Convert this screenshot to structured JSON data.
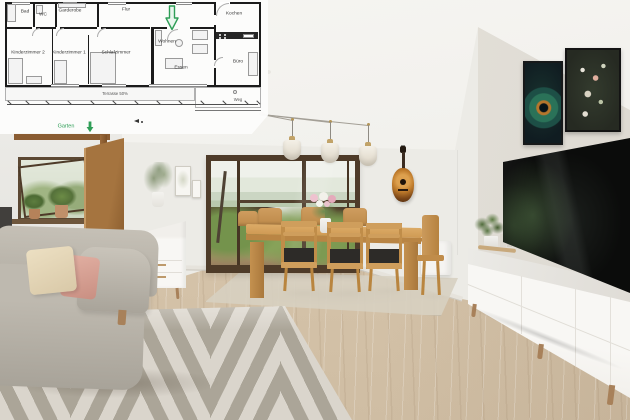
{
  "floorplan": {
    "rooms": [
      {
        "label": "Bad"
      },
      {
        "label": "WC"
      },
      {
        "label": "Garderobe"
      },
      {
        "label": "Flur"
      },
      {
        "label": "Kochen"
      },
      {
        "label": "Kinderzimmer 2"
      },
      {
        "label": "Kinderzimmer 1"
      },
      {
        "label": "Schlafzimmer"
      },
      {
        "label": "Wohnen"
      },
      {
        "label": "Essen"
      },
      {
        "label": "Büro"
      }
    ],
    "areas": {
      "terrace": "Terrasse 50%",
      "path": "Weg",
      "garden": "Garten"
    },
    "highlight_color": "#2f9e57",
    "wall_color": "#1b1b1b",
    "paper_color": "#fbfbfa"
  },
  "photo": {
    "colors": {
      "ceiling": "#f5f4f1",
      "wall": "#ecebe6",
      "floor_wood": "#d2c0a6",
      "window_frame": "#4e3b29",
      "foliage": "#7d9a52",
      "table_oak": "#cf9a54",
      "rug_light": "#dad5cc",
      "rug_dark": "#aba598",
      "sofa": "#b9b4aa",
      "cushion_cream": "#e7dcc0",
      "cushion_blush": "#d8a396",
      "sideboard": "#f6f5f2",
      "tv_screen": "#0b0c0b",
      "guitar_body": "#c07c2c",
      "door_wood": "#8a5c32"
    }
  }
}
